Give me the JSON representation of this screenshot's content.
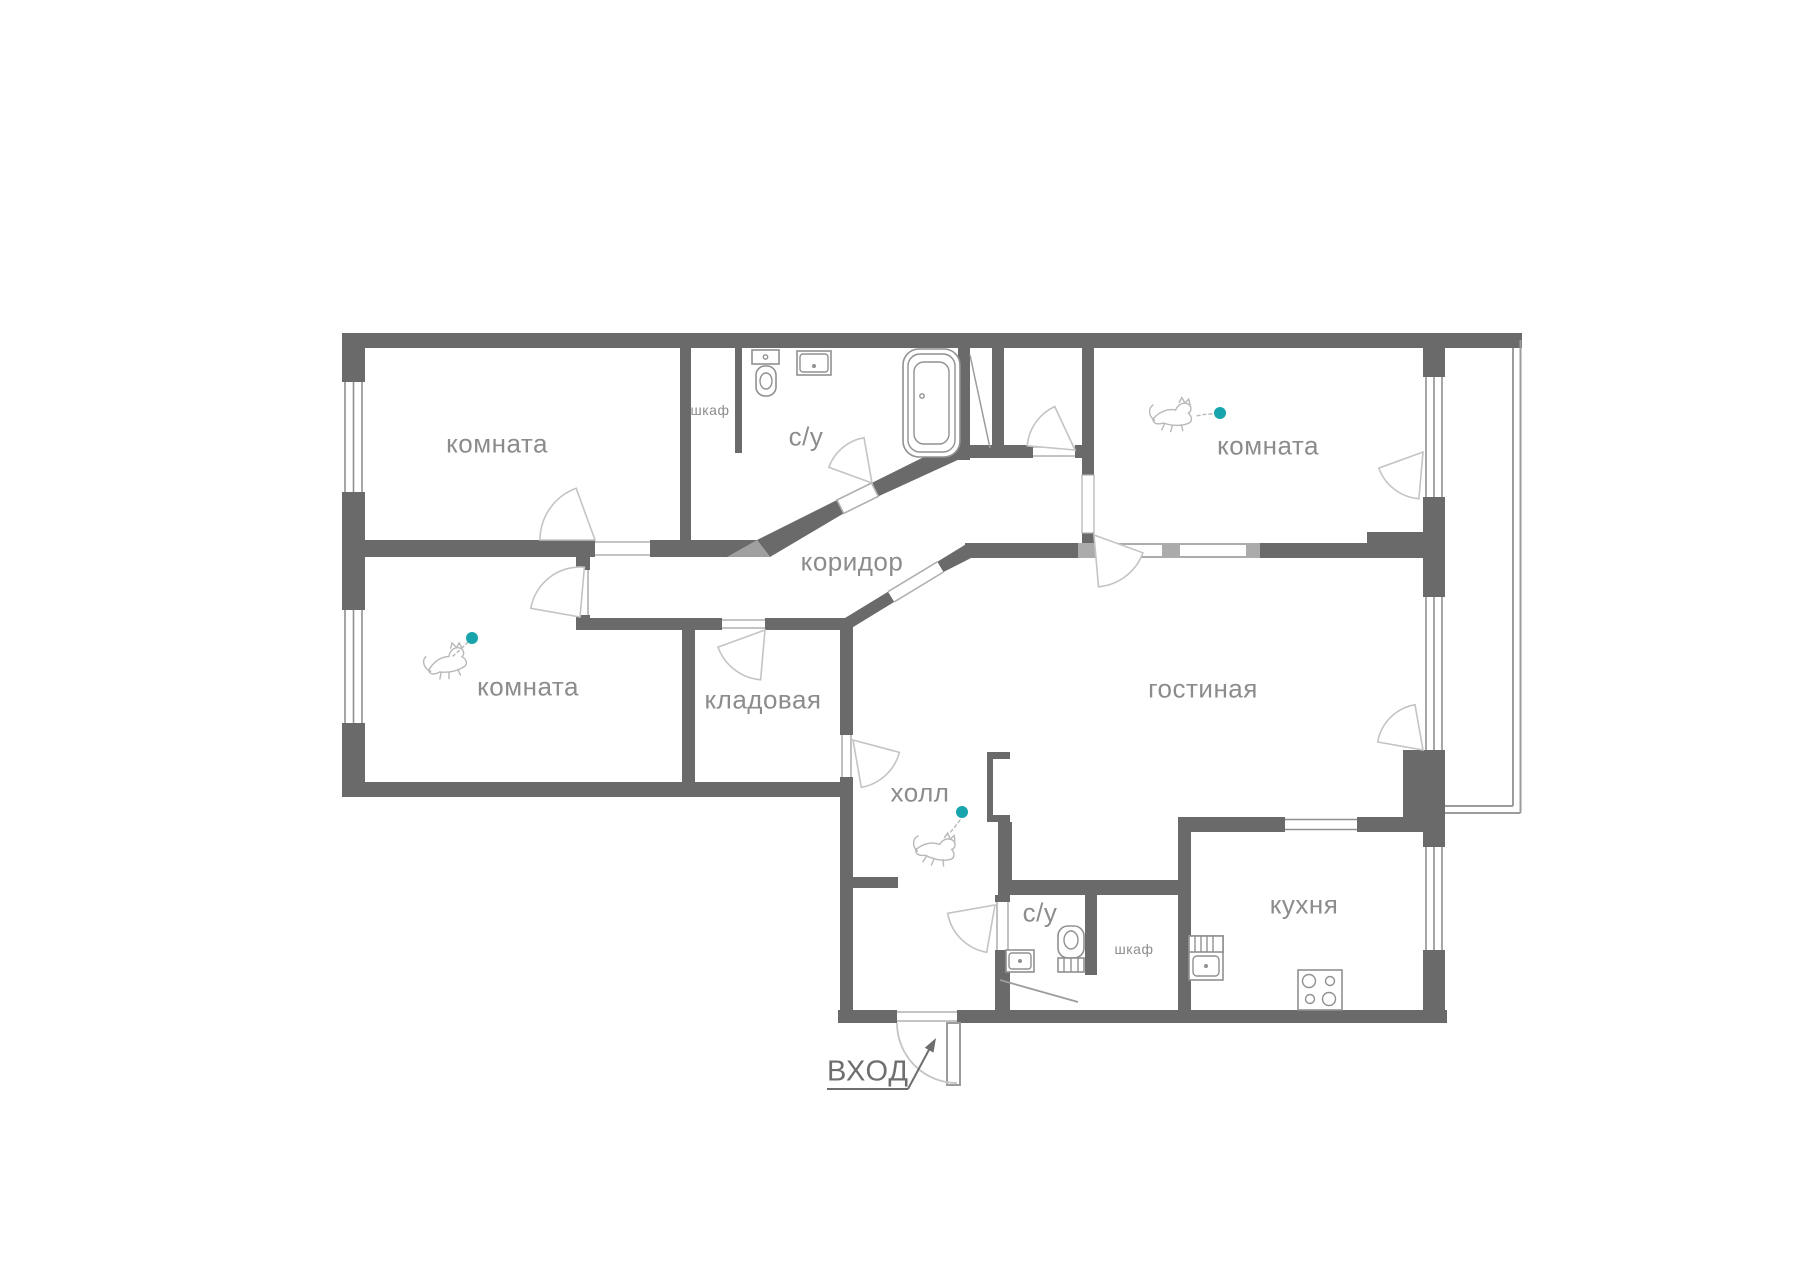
{
  "labels": {
    "room_top_left": "комната",
    "closet_top": "шкаф",
    "bathroom_top": "с/у",
    "room_top_right": "комната",
    "corridor": "коридор",
    "room_left": "комната",
    "storage": "кладовая",
    "living_room": "гостиная",
    "hall": "холл",
    "bathroom_bottom": "с/у",
    "closet_bottom": "шкаф",
    "kitchen": "кухня",
    "entrance": "ВХОД"
  },
  "colors": {
    "wall": "#6a6a6a",
    "door": "#c4c4c4",
    "threshold": "#b0b0b0",
    "opening_band": "#ababab",
    "fixture": "#909090",
    "label": "#8c8c8c",
    "entrance": "#6e6e6e",
    "accent": "#18a4ac",
    "sketch": "#b8b8b8"
  }
}
